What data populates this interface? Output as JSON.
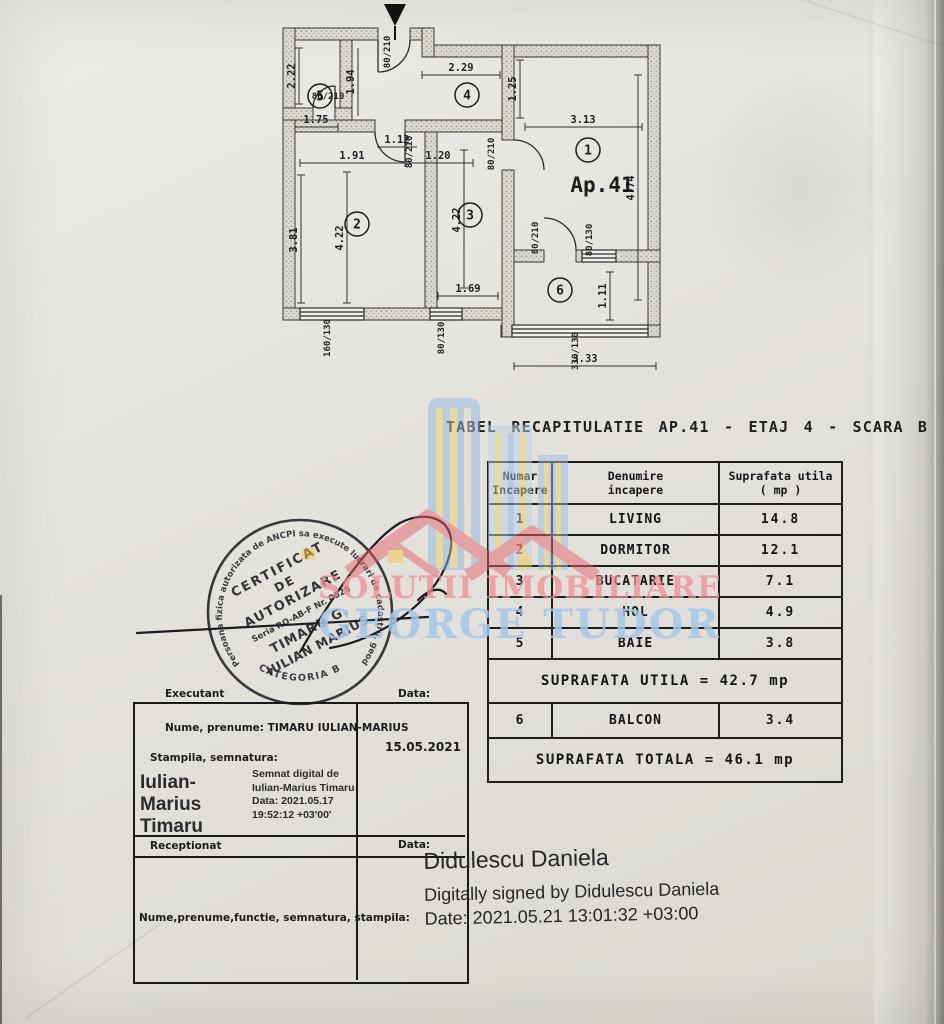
{
  "title": "TABEL RECAPITULATIE AP.41 - ETAJ 4 - SCARA B",
  "floor_plan": {
    "apartment_label": "Ap.41",
    "rooms": [
      "1",
      "2",
      "3",
      "4",
      "5",
      "6"
    ],
    "dims": {
      "baie_h": "2.22",
      "baie_w": "1.75",
      "entry_h": "1.94",
      "hall_w": "2.29",
      "hall_h": "1.25",
      "small": "1.12",
      "living_w": "3.13",
      "living_h": "4.74",
      "dorm_w": "1.91",
      "gap": "1.20",
      "dorm_h": "3.81",
      "dorm_h2": "4.22",
      "kitchen_h": "4.22",
      "kitchen_w": "1.69",
      "balcony_h": "1.11",
      "balcony_w": "3.33"
    },
    "openings": {
      "entry_door": "80/210",
      "baie_door": "80/210",
      "hall_door": "80/210",
      "living_door": "80/210",
      "balcony_door": "80/210",
      "balcony_window": "80/130",
      "dorm_window": "160/130",
      "kitchen_window": "80/130",
      "balcony_big_window": "330/130"
    }
  },
  "table": {
    "header": {
      "c1a": "Numar",
      "c1b": "Incapere",
      "c2a": "Denumire",
      "c2b": "incapere",
      "c3a": "Suprafata utila",
      "c3b": "( mp )"
    },
    "rows": [
      {
        "num": "1",
        "name": "LIVING",
        "area": "14.8"
      },
      {
        "num": "2",
        "name": "DORMITOR",
        "area": "12.1"
      },
      {
        "num": "3",
        "name": "BUCATARIE",
        "area": "7.1"
      },
      {
        "num": "4",
        "name": "HOL",
        "area": "4.9"
      },
      {
        "num": "5",
        "name": "BAIE",
        "area": "3.8"
      }
    ],
    "utila_line": "SUPRAFATA UTILA = 42.7 mp",
    "balcon_row": {
      "num": "6",
      "name": "BALCON",
      "area": "3.4"
    },
    "totala_line": "SUPRAFATA TOTALA = 46.1 mp"
  },
  "watermark": {
    "line1": "SOLUTII IMOBILIARE",
    "line2": "GEORGE TUDOR",
    "line1_color": "#ef8f94",
    "line2_color": "#a4c7ea",
    "building_blue": "#8fb6e2",
    "building_yellow": "#f0d060",
    "roof_red": "#e2636b"
  },
  "stamp": {
    "ring": "Persoana fizica autorizata de ANCPI sa execute lucrari de cadastru, geodezie si cartografie",
    "category": "CATEGORIA B",
    "l1": "CERTIFICAT",
    "l2": "DE",
    "l3": "AUTORIZARE",
    "l4": "Seria RO-AB-F  Nr. 0028",
    "l5": "TIMARU G.",
    "l6": "IULIAN MARIUS"
  },
  "form": {
    "executant_label": "Executant",
    "data_label_1": "Data:",
    "nume_line": "Nume, prenume: TIMARU IULIAN-MARIUS",
    "stampila_line": "Stampila, semnatura:",
    "date_value": "15.05.2021",
    "receptionat_label": "Receptionat",
    "data_label_2": "Data:",
    "bottom_line": "Nume,prenume,functie,  semnatura,  stampila:",
    "sig": {
      "name_l1": "Iulian-Marius",
      "name_l2": "Timaru",
      "d1": "Semnat digital de",
      "d2": "Iulian-Marius Timaru",
      "d3": "Data: 2021.05.17",
      "d4": "19:52:12 +03'00'"
    }
  },
  "signature2": {
    "name": "Didulescu Daniela",
    "line2": "Digitally signed by Didulescu Daniela",
    "line3": "Date: 2021.05.21 13:01:32 +03:00"
  }
}
